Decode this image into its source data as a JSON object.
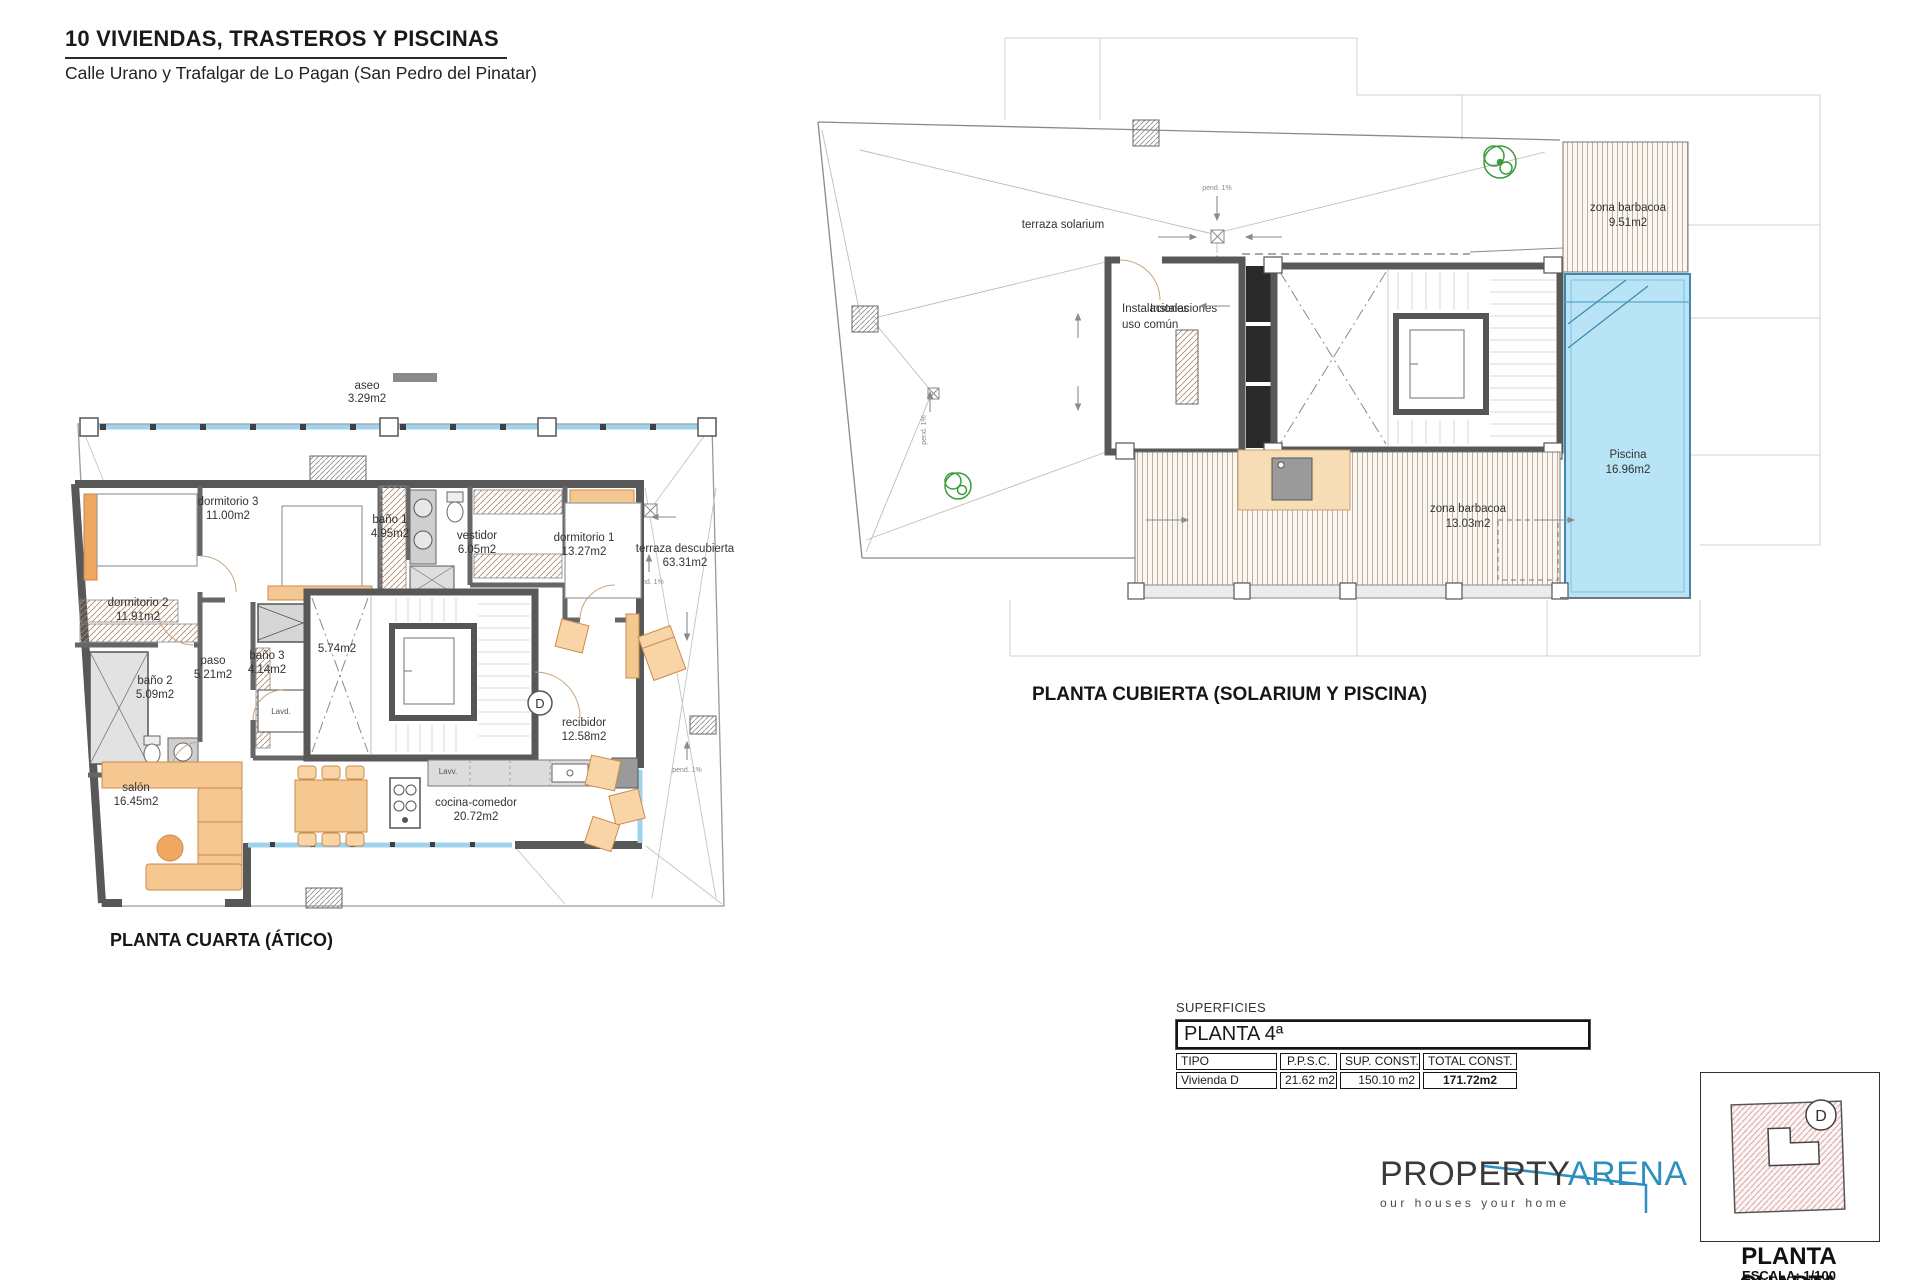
{
  "header": {
    "title": "10 VIVIENDAS, TRASTEROS Y PISCINAS",
    "subtitle": "Calle Urano y Trafalgar de Lo Pagan (San Pedro del Pinatar)"
  },
  "plan_atico": {
    "caption": "PLANTA CUARTA (ÁTICO)",
    "unit_badge": "D",
    "rooms": {
      "aseo": {
        "name": "aseo",
        "area": "3.29m2"
      },
      "dormitorio3": {
        "name": "dormitorio 3",
        "area": "11.00m2"
      },
      "bano1": {
        "name": "baño 1",
        "area": "4.95m2"
      },
      "vestidor": {
        "name": "vestidor",
        "area": "6.05m2"
      },
      "dormitorio1": {
        "name": "dormitorio 1",
        "area": "13.27m2"
      },
      "terraza": {
        "name": "terraza descubierta",
        "area": "63.31m2"
      },
      "dormitorio2": {
        "name": "dormitorio 2",
        "area": "11.91m2"
      },
      "paso": {
        "name": "paso",
        "area": "5.21m2"
      },
      "bano3": {
        "name": "baño 3",
        "area": "4.14m2"
      },
      "patio": {
        "area": "5.74m2"
      },
      "bano2": {
        "name": "baño 2",
        "area": "5.09m2"
      },
      "recibidor": {
        "name": "recibidor",
        "area": "12.58m2"
      },
      "salon": {
        "name": "salón",
        "area": "16.45m2"
      },
      "cocina": {
        "name": "cocina-comedor",
        "area": "20.72m2"
      }
    },
    "annotations": {
      "pend": "pend. 1%",
      "lavd": "Lavd.",
      "lavv": "Lavv."
    }
  },
  "plan_cubierta": {
    "caption": "PLANTA CUBIERTA (SOLARIUM Y PISCINA)",
    "rooms": {
      "solarium": {
        "name": "terraza solarium"
      },
      "barbacoa1": {
        "name": "zona barbacoa",
        "area": "9.51m2"
      },
      "instalaciones": {
        "name": "Instalaciones",
        "name2": "uso común"
      },
      "piscina": {
        "name": "Piscina",
        "area": "16.96m2"
      },
      "barbacoa2": {
        "name": "zona barbacoa",
        "area": "13.03m2"
      }
    },
    "annotations": {
      "pend": "pend. 1%"
    }
  },
  "surfaces_table": {
    "title": "SUPERFICIES",
    "floor": "PLANTA 4ª",
    "columns": [
      "TIPO",
      "P.P.S.C.",
      "SUP. CONST.",
      "TOTAL CONST."
    ],
    "row": [
      "Vivienda D",
      "21.62 m2",
      "150.10 m2",
      "171.72m2"
    ]
  },
  "logo": {
    "word1": "PROPERTY",
    "word2": "ARENA",
    "tagline": "our houses your home",
    "accent": "#2e8fbe"
  },
  "keyplan": {
    "unit_letter": "D",
    "caption": "PLANTA CUARTA",
    "scale": "ESCALA: 1/100"
  }
}
